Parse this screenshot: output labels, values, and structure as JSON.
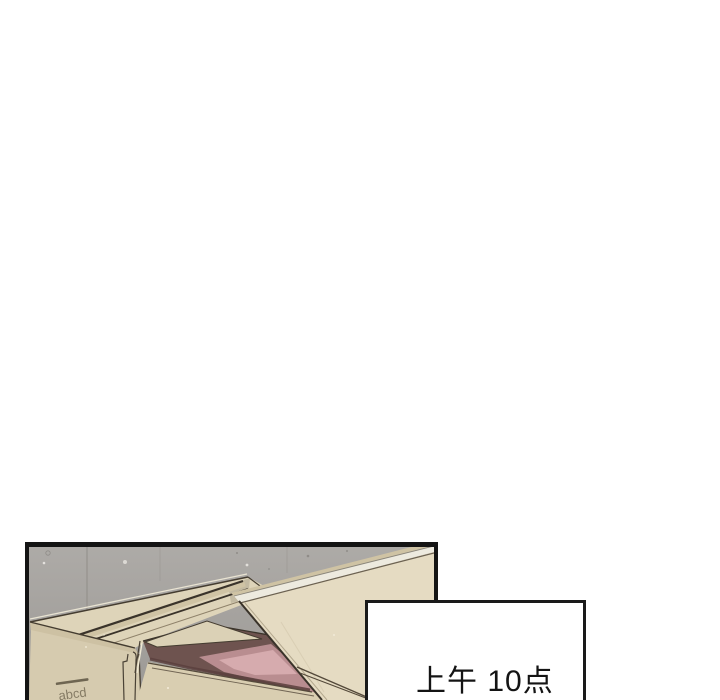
{
  "page": {
    "background_color": "#ffffff"
  },
  "comic_panel": {
    "border_color": "#141414",
    "wall_color": "#a7a4a0",
    "closed_box": {
      "logo_text": "abcd",
      "top_color": "#ded4b9",
      "front_color": "#d6cbaf",
      "tape_color": "#3a332a"
    },
    "open_box": {
      "flap_color": "#e5dbc2",
      "front_color": "#d9ceb1",
      "interior_color": "#6e534f",
      "contents_pink": "#d6abae"
    }
  },
  "caption_box": {
    "text": "上午 10点",
    "background_color": "#ffffff",
    "border_color": "#1a1a1a",
    "text_color": "#141414"
  }
}
